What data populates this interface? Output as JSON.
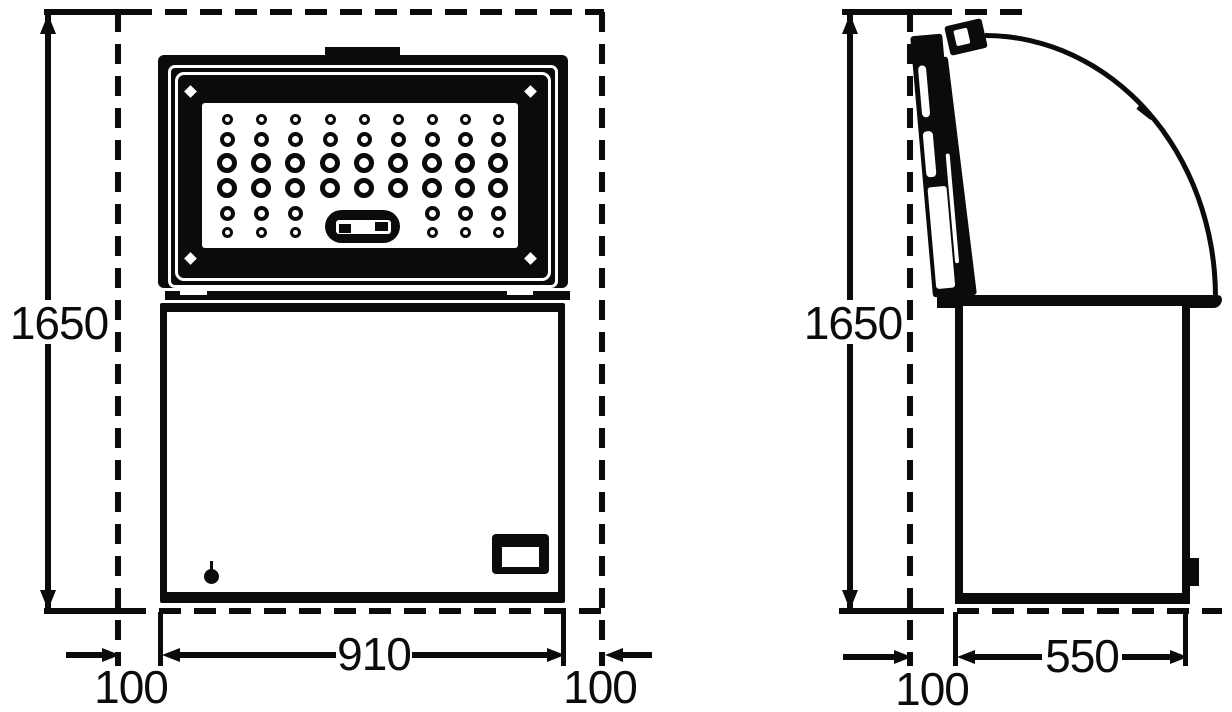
{
  "title": "chest-freezer-dimension-drawing",
  "front": {
    "height_label": "1650",
    "width_label": "910",
    "left_margin_label": "100",
    "right_margin_label": "100"
  },
  "side": {
    "height_label": "1650",
    "depth_label": "550",
    "margin_label": "100"
  },
  "holes": {
    "cols": [
      227,
      261,
      295,
      330,
      364,
      398,
      432,
      465,
      498
    ],
    "rows": [
      {
        "y": 119,
        "d": 11,
        "ring": 3,
        "skip": []
      },
      {
        "y": 139,
        "d": 15,
        "ring": 4,
        "skip": []
      },
      {
        "y": 163,
        "d": 20,
        "ring": 5,
        "skip": []
      },
      {
        "y": 188,
        "d": 20,
        "ring": 5,
        "skip": []
      },
      {
        "y": 213,
        "d": 15,
        "ring": 4,
        "skip": [
          3,
          4,
          5
        ]
      },
      {
        "y": 232,
        "d": 11,
        "ring": 3,
        "skip": [
          3,
          4,
          5
        ]
      }
    ]
  },
  "colors": {
    "ink": "#0b0b0b",
    "paper": "#ffffff"
  }
}
